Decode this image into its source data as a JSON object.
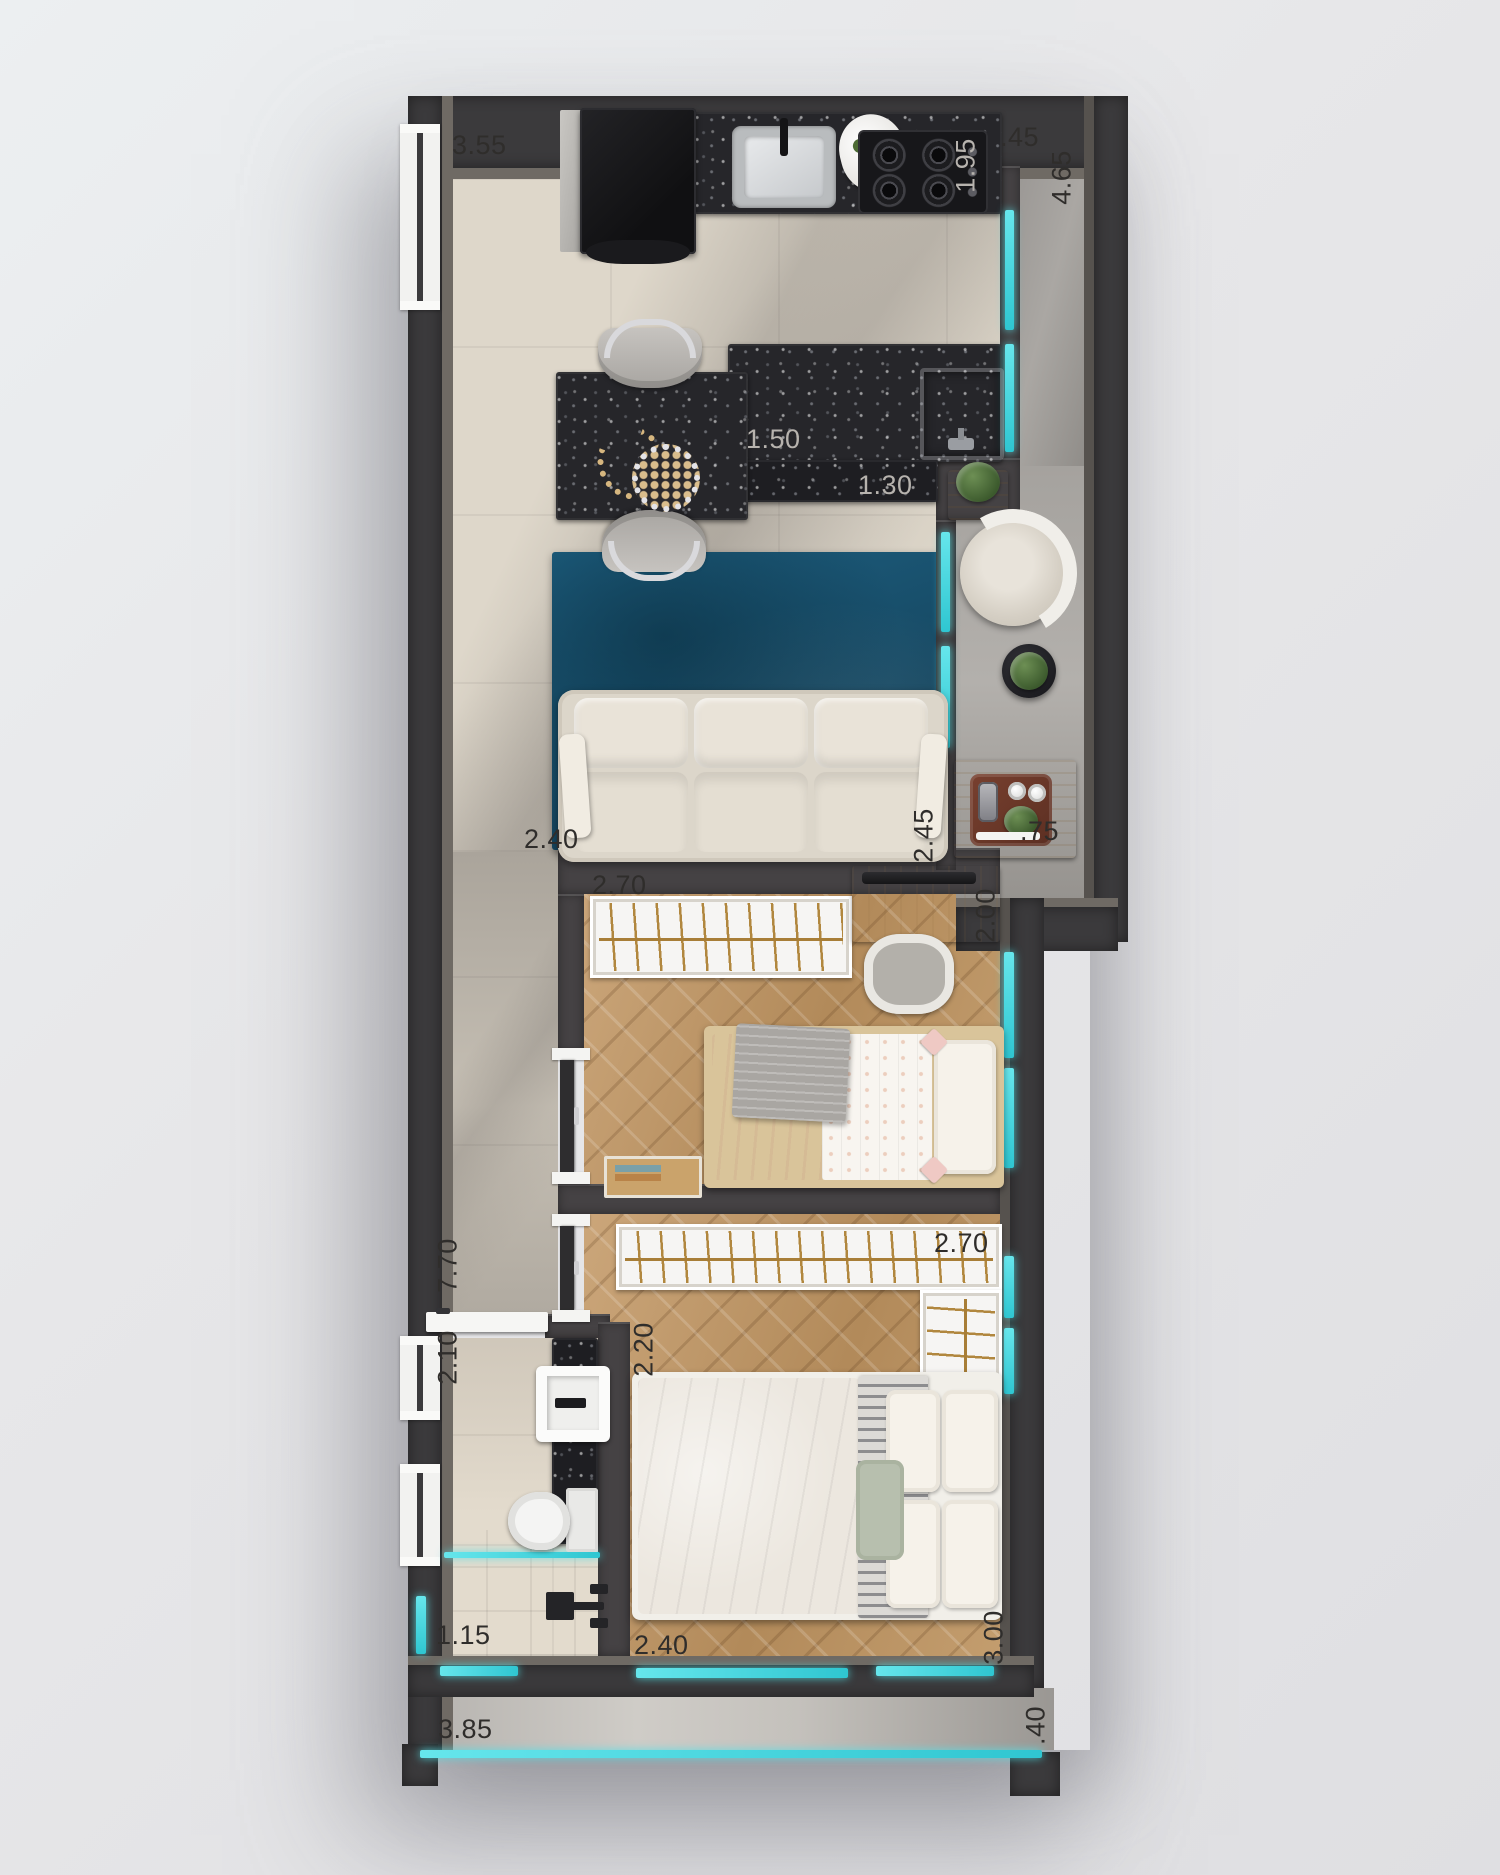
{
  "plan": {
    "dimensions": {
      "d355": "3.55",
      "d045": ".45",
      "d195": "1.95",
      "d465": "4.65",
      "d150": "1.50",
      "d130": "1.30",
      "d240a": "2.40",
      "d245": "2.45",
      "d075": ".75",
      "d270a": "2.70",
      "d200": "2.00",
      "d770": "7.70",
      "d210": "2.10",
      "d220": "2.20",
      "d270b": "2.70",
      "d115": "1.15",
      "d240b": "2.40",
      "d300": "3.00",
      "d385": "3.85",
      "d040": ".40"
    },
    "colors": {
      "glass_accent": "#4fd9e0",
      "wall": "#3b3a3c",
      "wood_floor": "#c09a6b",
      "tile_floor": "#ded7ca",
      "granite": "#26262a",
      "rug": "#1c5671",
      "terrace": "#c2bfba",
      "background": "#e7e7e9"
    }
  }
}
